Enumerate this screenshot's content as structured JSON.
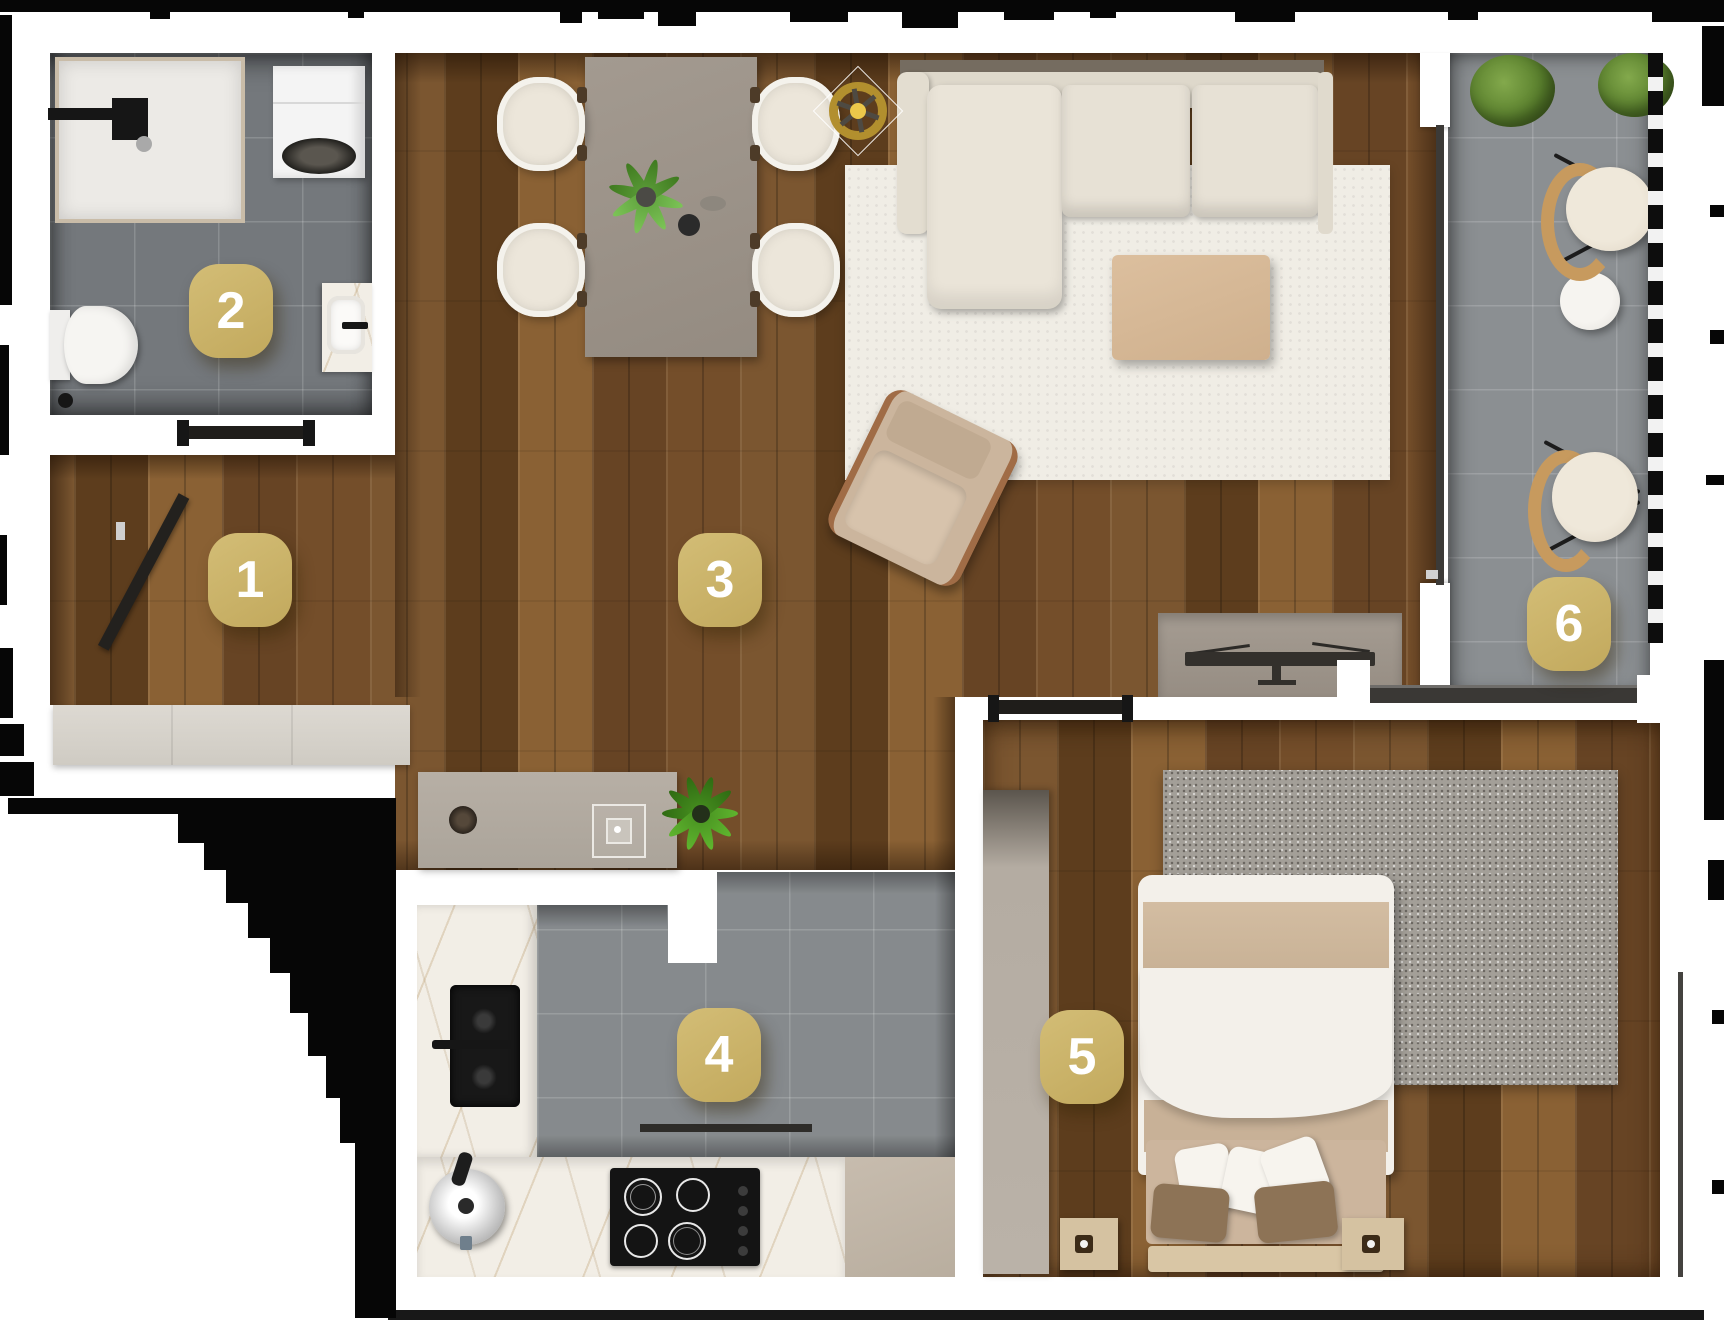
{
  "floorplan": {
    "type": "apartment-top-view-render",
    "rooms": [
      {
        "number": "1"
      },
      {
        "number": "2"
      },
      {
        "number": "3"
      },
      {
        "number": "4"
      },
      {
        "number": "5"
      },
      {
        "number": "6"
      }
    ],
    "palette": {
      "marker_bg": "#c9b267",
      "marker_text": "#ffffff",
      "wood_floor": "#6e4a26",
      "tile_gray": "#868a8d",
      "bathroom_tile": "#74787c",
      "wall_white": "#ffffff",
      "outer_mask": "#060606",
      "sofa_cream": "#e7e1d5",
      "coffee_table_tan": "#d6b896",
      "marble": "#f2eee6",
      "rattan": "#c79a5e",
      "plant_green": "#5d8f33",
      "bed_blanket_tan": "#cdb59a"
    }
  }
}
